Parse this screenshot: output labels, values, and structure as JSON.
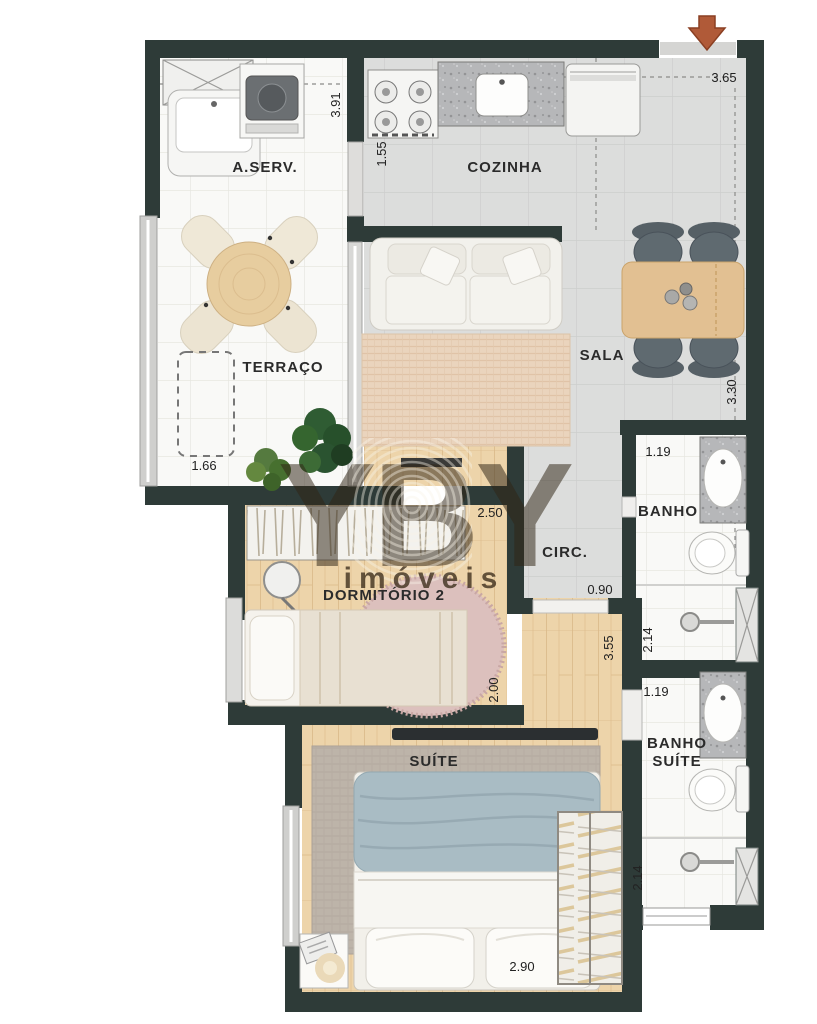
{
  "plan": {
    "watermark_brand": "YBY",
    "watermark_subtitle": "imóveis"
  },
  "rooms": [
    {
      "id": "a-serv",
      "label": "A.SERV."
    },
    {
      "id": "cozinha",
      "label": "COZINHA"
    },
    {
      "id": "terraco",
      "label": "TERRAÇO"
    },
    {
      "id": "sala",
      "label": "SALA"
    },
    {
      "id": "banho",
      "label": "BANHO"
    },
    {
      "id": "circ",
      "label": "CIRC."
    },
    {
      "id": "dormitorio-2",
      "label": "DORMITÓRIO 2"
    },
    {
      "id": "banho-suite",
      "label": "BANHO",
      "label2": "SUÍTE"
    },
    {
      "id": "suite",
      "label": "SUÍTE"
    }
  ],
  "dimensions": [
    {
      "value": "3.91",
      "location": "a-serv-depth"
    },
    {
      "value": "1.55",
      "location": "cozinha-width"
    },
    {
      "value": "3.65",
      "location": "sala-width"
    },
    {
      "value": "3.30",
      "location": "sala-depth"
    },
    {
      "value": "1.66",
      "location": "terraco-width"
    },
    {
      "value": "2.50",
      "location": "dormitorio-2-width"
    },
    {
      "value": "0.90",
      "location": "circ-opening"
    },
    {
      "value": "1.19",
      "location": "banho-width"
    },
    {
      "value": "2.14",
      "location": "banho-box"
    },
    {
      "value": "3.55",
      "location": "suite-hall-depth"
    },
    {
      "value": "2.00",
      "location": "dormitorio-2-depth"
    },
    {
      "value": "1.19",
      "location": "banho-suite-width"
    },
    {
      "value": "2.14",
      "location": "banho-suite-box"
    },
    {
      "value": "2.90",
      "location": "suite-width"
    }
  ],
  "icons": {
    "entrance": "arrow-down"
  },
  "colors": {
    "wall": "#2e3b38",
    "wood_floor": "#edd4aa",
    "entrance_arrow": "#b05a38",
    "rug_pink": "#dcc0bd",
    "rug_gray": "#bdb4a9",
    "bed_blue": "#a9bcc4"
  }
}
